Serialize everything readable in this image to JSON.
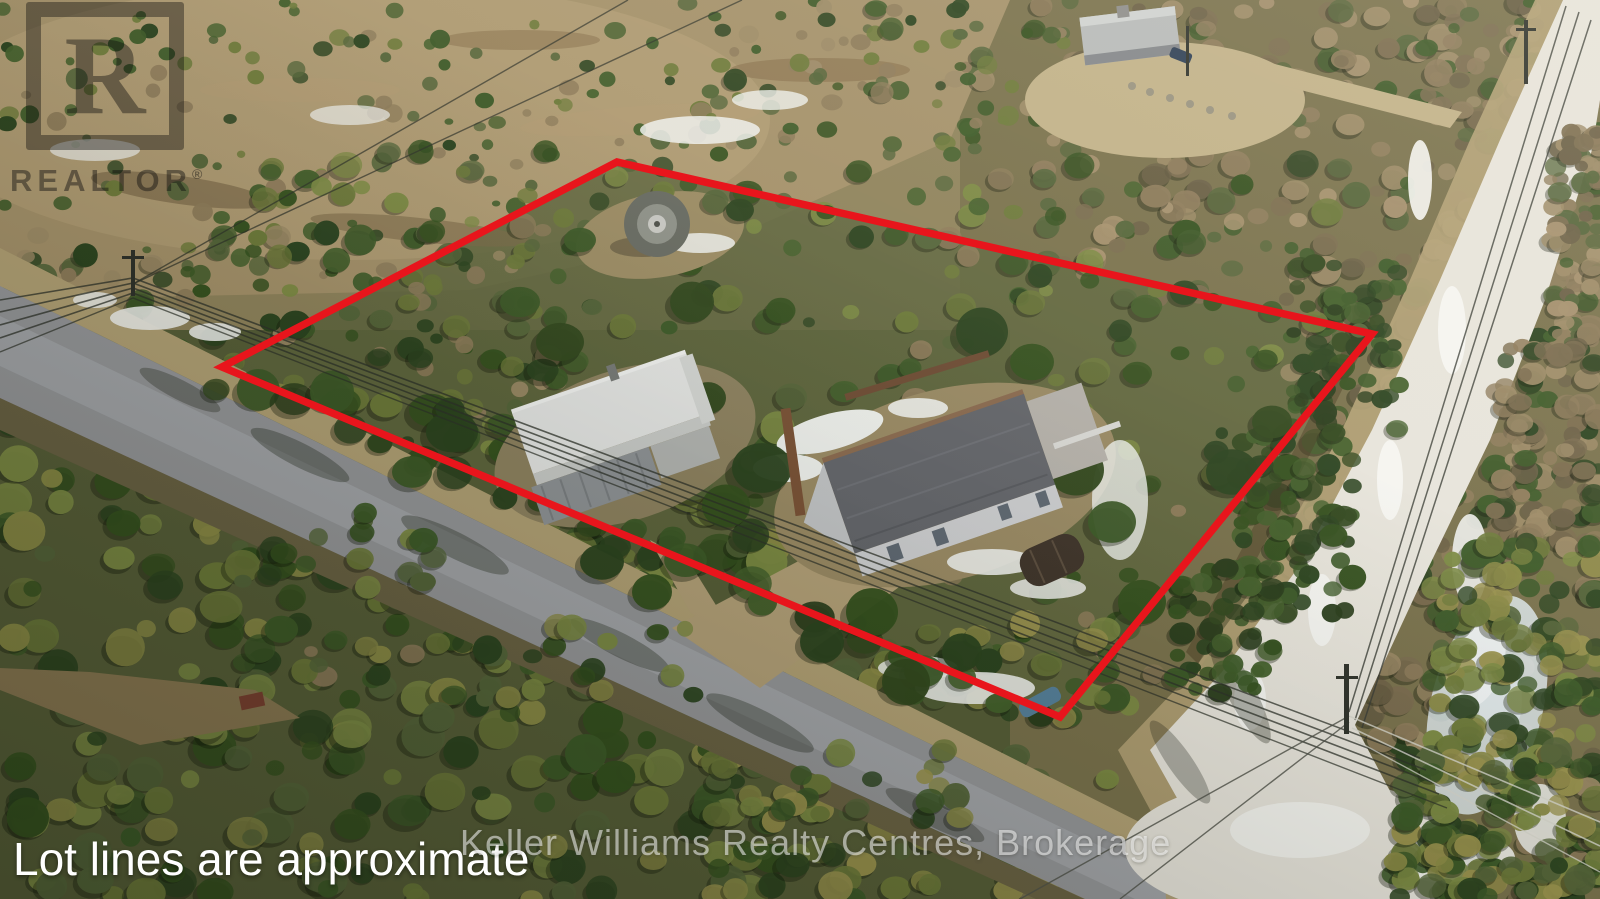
{
  "overlay": {
    "disclaimer_text": "Lot lines are approximate",
    "lot_line_color": "#e8151c"
  },
  "watermarks": {
    "realtor_logo_letter": "R",
    "realtor_logo_text": "REALTOR",
    "realtor_logo_reg": "®",
    "brokerage_text": "Keller Williams Realty Centres, Brokerage"
  }
}
